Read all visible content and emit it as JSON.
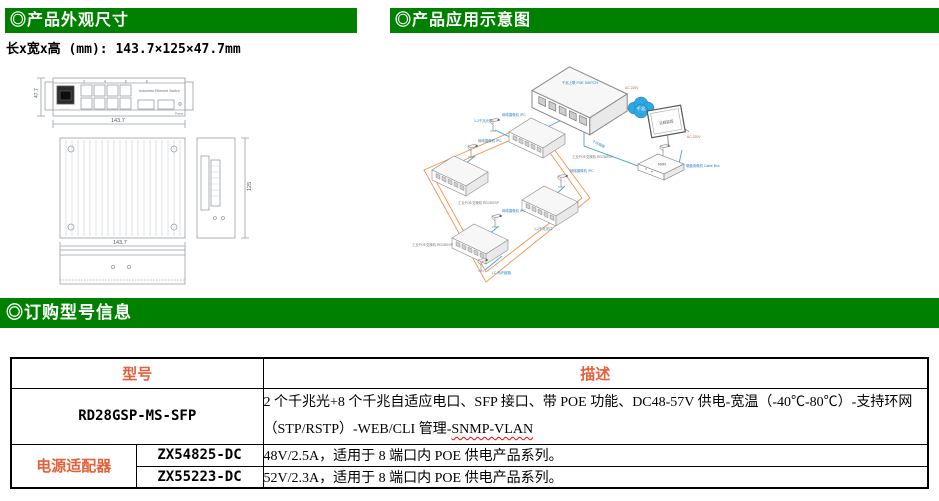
{
  "sections": {
    "appearance_title": "◎产品外观尺寸",
    "application_title": "◎产品应用示意图",
    "ordering_title": "◎订购型号信息"
  },
  "dimensions_line": "长x宽x高 (mm): 143.7×125×47.7mm",
  "drawing": {
    "device_label": "Industrial Ethernet Switch",
    "console_label": "Console",
    "power_label": "Power",
    "port_numbers": "2    4    6    8",
    "dim_length_front": "143.7",
    "dim_height_front": "47.7",
    "dim_length_top": "143.7",
    "dim_width_side": "125"
  },
  "diagram": {
    "cloud_label": "千兆",
    "monitor_label": "远程监控",
    "nvr_label": "NVR",
    "labels": [
      {
        "text": "千兆上联 POE SWITCH"
      },
      {
        "text": "AC 220V"
      },
      {
        "text": "AC 220V"
      },
      {
        "text": "硬盘录像机 Cable Box"
      },
      {
        "text": "千兆链路"
      },
      {
        "text": "1-2千兆光口"
      },
      {
        "text": "网络摄像机 IPC"
      },
      {
        "text": "网络摄像机 IPC"
      },
      {
        "text": "网络摄像机 IPC"
      },
      {
        "text": "网络摄像机 IPC"
      },
      {
        "text": "工业POE交换机 RD28GSP"
      },
      {
        "text": "工业POE交换机 RD28GSP"
      },
      {
        "text": "工业POE交换机 RD28GSP"
      },
      {
        "text": "1-2千兆光口"
      },
      {
        "text": "LC 光纤链路"
      }
    ]
  },
  "table": {
    "header_model": "型号",
    "header_description": "描述",
    "main_row": {
      "model": "RD28GSP-MS-SFP",
      "desc_line1": "2 个千兆光+8 个千兆自适应电口、SFP 接口、带 POE 功能、DC48-57V 供电-宽温（-40℃-80℃）-支持环网",
      "desc_line2_pre": "（STP/RSTP）-WEB/CLI 管理-",
      "desc_line2_underlined": "SNMP-VLAN"
    },
    "adapter_group_label": "电源适配器",
    "adapter_rows": [
      {
        "model": "ZX54825-DC",
        "description": "48V/2.5A，适用于 8 端口内 POE 供电产品系列。"
      },
      {
        "model": "ZX55223-DC",
        "description": "52V/2.3A，适用于 8 端口内 POE 供电产品系列。"
      }
    ]
  },
  "colors": {
    "header_green": "#008000",
    "accent_orange": "#E4603A",
    "line_blue": "#3AA6DC",
    "ring_orange": "#F2924D",
    "alert_red": "#D9534F"
  }
}
